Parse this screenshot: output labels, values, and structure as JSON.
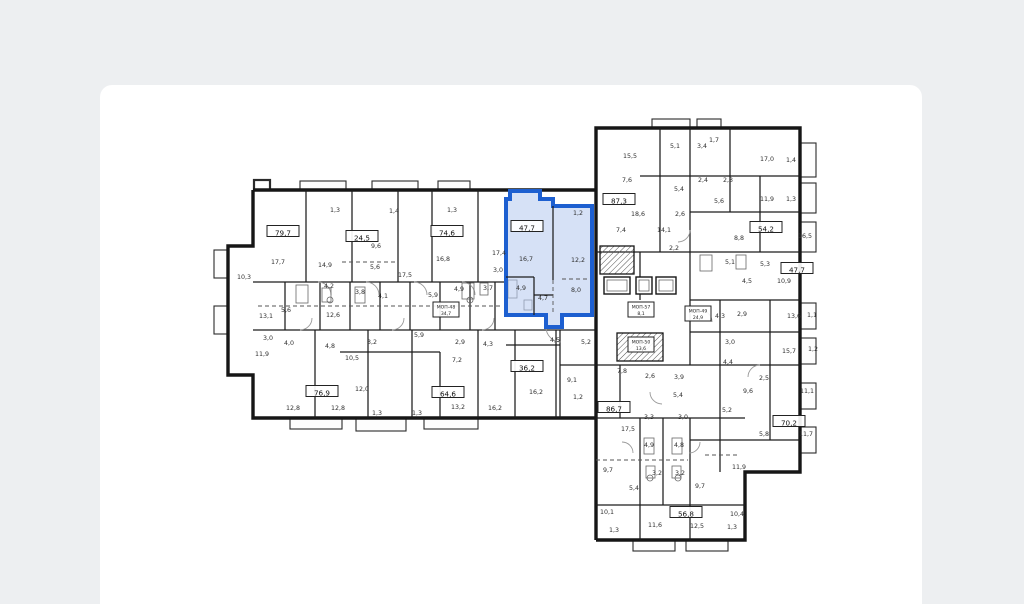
{
  "page": {
    "background": "#edeff1",
    "card_background": "#ffffff"
  },
  "colors": {
    "wall": "#161616",
    "label": "#2f2f2f",
    "highlight_stroke": "#1d5fd0",
    "highlight_fill": "#b5c9ef"
  },
  "selected_apartment": {
    "area": "47,7"
  },
  "floorplan": {
    "badges": [
      {
        "x": 283,
        "y": 233,
        "label": "79,7"
      },
      {
        "x": 362,
        "y": 238,
        "label": "24,5"
      },
      {
        "x": 447,
        "y": 233,
        "label": "74,6"
      },
      {
        "x": 527,
        "y": 228,
        "label": "47,7",
        "highlight": true
      },
      {
        "x": 619,
        "y": 201,
        "label": "87,3"
      },
      {
        "x": 766,
        "y": 229,
        "label": "54,2"
      },
      {
        "x": 797,
        "y": 270,
        "label": "47,7"
      },
      {
        "x": 527,
        "y": 368,
        "label": "36,2"
      },
      {
        "x": 322,
        "y": 393,
        "label": "76,9"
      },
      {
        "x": 448,
        "y": 394,
        "label": "64,6"
      },
      {
        "x": 614,
        "y": 409,
        "label": "86,7"
      },
      {
        "x": 789,
        "y": 423,
        "label": "70,2"
      },
      {
        "x": 686,
        "y": 514,
        "label": "56,8"
      }
    ],
    "core_badges": [
      {
        "x": 446,
        "y": 311,
        "line1": "МОП-48",
        "line2": "34,7"
      },
      {
        "x": 641,
        "y": 311,
        "line1": "МОП-57",
        "line2": "8,1"
      },
      {
        "x": 698,
        "y": 315,
        "line1": "МОП-49",
        "line2": "24,9"
      },
      {
        "x": 641,
        "y": 346,
        "line1": "МОП-50",
        "line2": "13,6"
      }
    ],
    "rooms": [
      {
        "x": 335,
        "y": 212,
        "label": "1,3"
      },
      {
        "x": 394,
        "y": 213,
        "label": "1,4"
      },
      {
        "x": 452,
        "y": 212,
        "label": "1,3"
      },
      {
        "x": 278,
        "y": 264,
        "label": "17,7"
      },
      {
        "x": 325,
        "y": 267,
        "label": "14,9"
      },
      {
        "x": 376,
        "y": 248,
        "label": "9,6"
      },
      {
        "x": 375,
        "y": 269,
        "label": "5,6"
      },
      {
        "x": 405,
        "y": 277,
        "label": "17,5"
      },
      {
        "x": 443,
        "y": 261,
        "label": "16,8"
      },
      {
        "x": 499,
        "y": 255,
        "label": "17,4"
      },
      {
        "x": 498,
        "y": 272,
        "label": "3,0"
      },
      {
        "x": 244,
        "y": 279,
        "label": "10,3"
      },
      {
        "x": 329,
        "y": 288,
        "label": "4,2"
      },
      {
        "x": 360,
        "y": 294,
        "label": "3,8"
      },
      {
        "x": 383,
        "y": 298,
        "label": "4,1"
      },
      {
        "x": 433,
        "y": 297,
        "label": "5,9"
      },
      {
        "x": 459,
        "y": 291,
        "label": "4,9"
      },
      {
        "x": 488,
        "y": 290,
        "label": "3,7"
      },
      {
        "x": 286,
        "y": 312,
        "label": "5,6"
      },
      {
        "x": 266,
        "y": 318,
        "label": "13,1"
      },
      {
        "x": 333,
        "y": 317,
        "label": "12,6"
      },
      {
        "x": 268,
        "y": 340,
        "label": "3,0"
      },
      {
        "x": 289,
        "y": 345,
        "label": "4,0"
      },
      {
        "x": 330,
        "y": 348,
        "label": "4,8"
      },
      {
        "x": 262,
        "y": 356,
        "label": "11,9"
      },
      {
        "x": 352,
        "y": 360,
        "label": "10,5"
      },
      {
        "x": 372,
        "y": 344,
        "label": "3,2"
      },
      {
        "x": 419,
        "y": 337,
        "label": "5,9"
      },
      {
        "x": 460,
        "y": 344,
        "label": "2,9"
      },
      {
        "x": 488,
        "y": 346,
        "label": "4,3"
      },
      {
        "x": 457,
        "y": 362,
        "label": "7,2"
      },
      {
        "x": 362,
        "y": 391,
        "label": "12,0"
      },
      {
        "x": 293,
        "y": 410,
        "label": "12,8"
      },
      {
        "x": 338,
        "y": 410,
        "label": "12,8"
      },
      {
        "x": 458,
        "y": 409,
        "label": "13,2"
      },
      {
        "x": 495,
        "y": 410,
        "label": "16,2"
      },
      {
        "x": 536,
        "y": 394,
        "label": "16,2"
      },
      {
        "x": 377,
        "y": 415,
        "label": "1,3"
      },
      {
        "x": 417,
        "y": 415,
        "label": "1,3"
      },
      {
        "x": 555,
        "y": 342,
        "label": "4,5"
      },
      {
        "x": 586,
        "y": 344,
        "label": "5,2"
      },
      {
        "x": 572,
        "y": 382,
        "label": "9,1"
      },
      {
        "x": 578,
        "y": 399,
        "label": "1,2"
      },
      {
        "x": 578,
        "y": 215,
        "label": "1,2"
      },
      {
        "x": 526,
        "y": 261,
        "label": "16,7"
      },
      {
        "x": 578,
        "y": 262,
        "label": "12,2"
      },
      {
        "x": 521,
        "y": 290,
        "label": "4,9"
      },
      {
        "x": 543,
        "y": 300,
        "label": "4,7"
      },
      {
        "x": 576,
        "y": 292,
        "label": "8,0"
      },
      {
        "x": 630,
        "y": 158,
        "label": "15,5"
      },
      {
        "x": 675,
        "y": 148,
        "label": "5,1"
      },
      {
        "x": 702,
        "y": 148,
        "label": "3,4"
      },
      {
        "x": 714,
        "y": 142,
        "label": "1,7"
      },
      {
        "x": 767,
        "y": 161,
        "label": "17,0"
      },
      {
        "x": 791,
        "y": 162,
        "label": "1,4"
      },
      {
        "x": 703,
        "y": 182,
        "label": "2,4"
      },
      {
        "x": 728,
        "y": 182,
        "label": "2,3"
      },
      {
        "x": 679,
        "y": 191,
        "label": "5,4"
      },
      {
        "x": 719,
        "y": 203,
        "label": "5,6"
      },
      {
        "x": 767,
        "y": 201,
        "label": "11,9"
      },
      {
        "x": 791,
        "y": 201,
        "label": "1,3"
      },
      {
        "x": 627,
        "y": 182,
        "label": "7,6"
      },
      {
        "x": 638,
        "y": 216,
        "label": "18,6"
      },
      {
        "x": 680,
        "y": 216,
        "label": "2,6"
      },
      {
        "x": 621,
        "y": 232,
        "label": "7,4"
      },
      {
        "x": 664,
        "y": 232,
        "label": "14,1"
      },
      {
        "x": 674,
        "y": 250,
        "label": "2,2"
      },
      {
        "x": 739,
        "y": 240,
        "label": "8,8"
      },
      {
        "x": 805,
        "y": 238,
        "label": "16,5"
      },
      {
        "x": 730,
        "y": 264,
        "label": "5,1"
      },
      {
        "x": 765,
        "y": 266,
        "label": "5,3"
      },
      {
        "x": 747,
        "y": 283,
        "label": "4,5"
      },
      {
        "x": 784,
        "y": 283,
        "label": "10,9"
      },
      {
        "x": 720,
        "y": 318,
        "label": "4,3"
      },
      {
        "x": 742,
        "y": 316,
        "label": "2,9"
      },
      {
        "x": 794,
        "y": 318,
        "label": "13,6"
      },
      {
        "x": 812,
        "y": 317,
        "label": "1,1"
      },
      {
        "x": 730,
        "y": 344,
        "label": "3,0"
      },
      {
        "x": 789,
        "y": 353,
        "label": "15,7"
      },
      {
        "x": 813,
        "y": 351,
        "label": "1,2"
      },
      {
        "x": 728,
        "y": 364,
        "label": "4,4"
      },
      {
        "x": 764,
        "y": 380,
        "label": "2,5"
      },
      {
        "x": 748,
        "y": 393,
        "label": "9,6"
      },
      {
        "x": 807,
        "y": 393,
        "label": "11,1"
      },
      {
        "x": 727,
        "y": 412,
        "label": "5,2"
      },
      {
        "x": 764,
        "y": 436,
        "label": "5,8"
      },
      {
        "x": 806,
        "y": 436,
        "label": "11,7"
      },
      {
        "x": 739,
        "y": 469,
        "label": "11,9"
      },
      {
        "x": 737,
        "y": 516,
        "label": "10,4"
      },
      {
        "x": 732,
        "y": 529,
        "label": "1,3"
      },
      {
        "x": 622,
        "y": 373,
        "label": "7,8"
      },
      {
        "x": 650,
        "y": 378,
        "label": "2,6"
      },
      {
        "x": 679,
        "y": 379,
        "label": "3,9"
      },
      {
        "x": 678,
        "y": 397,
        "label": "5,4"
      },
      {
        "x": 649,
        "y": 419,
        "label": "3,3"
      },
      {
        "x": 683,
        "y": 419,
        "label": "3,0"
      },
      {
        "x": 628,
        "y": 431,
        "label": "17,5"
      },
      {
        "x": 649,
        "y": 447,
        "label": "4,9"
      },
      {
        "x": 679,
        "y": 447,
        "label": "4,8"
      },
      {
        "x": 657,
        "y": 475,
        "label": "3,2"
      },
      {
        "x": 680,
        "y": 475,
        "label": "3,2"
      },
      {
        "x": 608,
        "y": 472,
        "label": "9,7"
      },
      {
        "x": 700,
        "y": 488,
        "label": "9,7"
      },
      {
        "x": 634,
        "y": 490,
        "label": "5,4"
      },
      {
        "x": 607,
        "y": 514,
        "label": "10,1"
      },
      {
        "x": 614,
        "y": 532,
        "label": "1,3"
      },
      {
        "x": 655,
        "y": 527,
        "label": "11,6"
      },
      {
        "x": 697,
        "y": 528,
        "label": "12,5"
      }
    ]
  }
}
